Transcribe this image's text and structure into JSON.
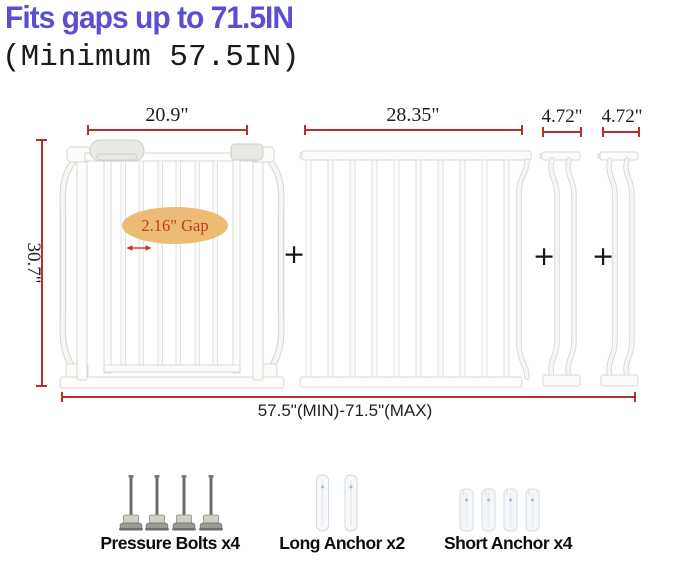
{
  "header": {
    "title": "Fits gaps up to 71.5IN",
    "subtitle": "(Minimum 57.5IN)"
  },
  "dimensions": {
    "main_gate_width": "20.9\"",
    "extension_panel_width": "28.35\"",
    "small_extension_1_width": "4.72\"",
    "small_extension_2_width": "4.72\"",
    "gate_height": "30.7\"",
    "bar_gap_label": "2.16\" Gap",
    "total_width_range": "57.5\"(MIN)-71.5\"(MAX)"
  },
  "separators": {
    "plus": "+"
  },
  "hardware": {
    "pressure_bolts_label": "Pressure Bolts x4",
    "long_anchor_label": "Long Anchor x2",
    "short_anchor_label": "Short Anchor x4"
  },
  "colors": {
    "title_text": "#5a4fd4",
    "dimension_line": "#b5302b",
    "gap_arrow": "#d92b20",
    "gap_callout_bg": "#ecbb74",
    "gap_callout_text": "#c43b25",
    "gate_fill": "#fcfcfa",
    "gate_outline": "#d8d8d4"
  }
}
